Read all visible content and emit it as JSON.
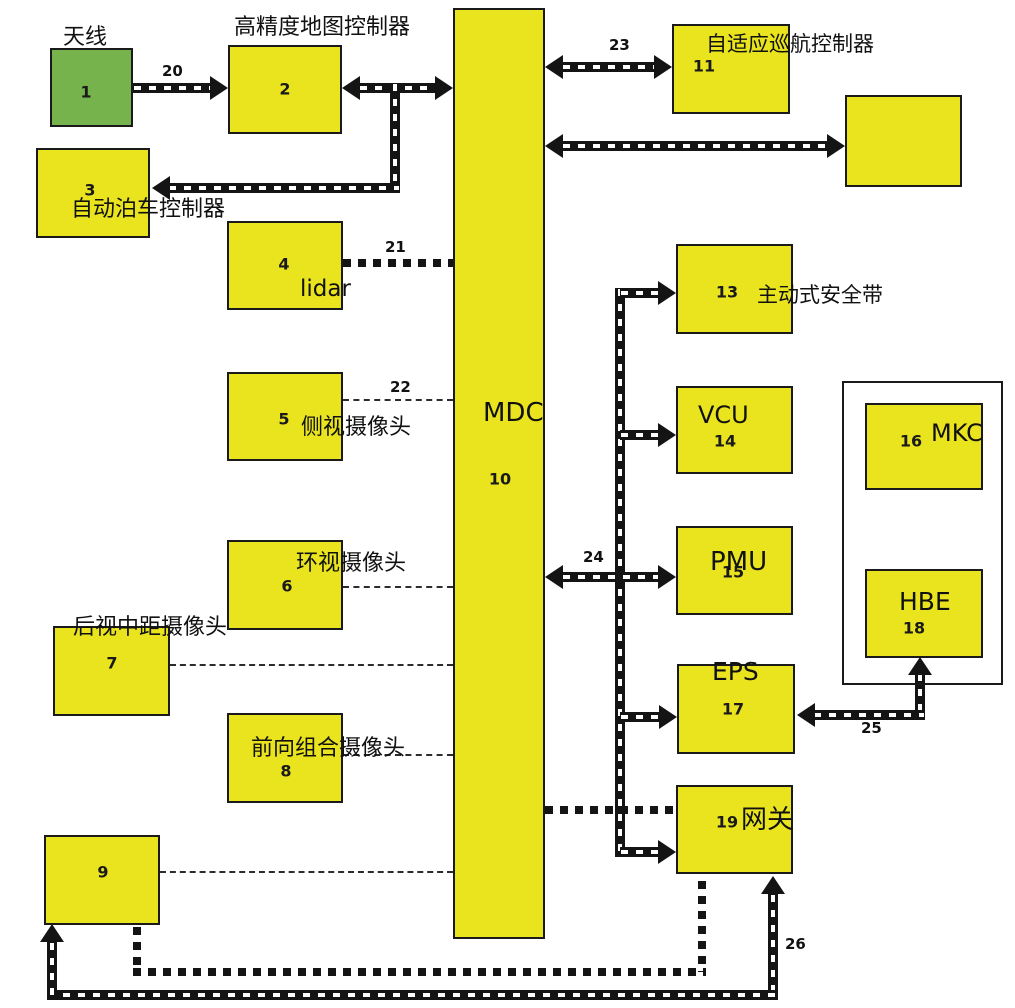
{
  "diagram": {
    "colors": {
      "box_fill": "#e9e41e",
      "antenna_fill": "#77b34d",
      "line": "#141414"
    },
    "nodes": [
      {
        "name": "node-antenna",
        "fill": "green",
        "num": "1",
        "x": 50,
        "y": 48,
        "w": 83,
        "h": 79,
        "numx": 86,
        "numy": 92
      },
      {
        "name": "node-hd-map-controller",
        "fill": "yellow",
        "num": "2",
        "x": 228,
        "y": 45,
        "w": 114,
        "h": 89,
        "numx": 285,
        "numy": 89
      },
      {
        "name": "node-auto-parking-controller",
        "fill": "yellow",
        "num": "3",
        "x": 36,
        "y": 148,
        "w": 114,
        "h": 90,
        "numx": 90,
        "numy": 190
      },
      {
        "name": "node-lidar",
        "fill": "yellow",
        "num": "4",
        "x": 227,
        "y": 221,
        "w": 116,
        "h": 89,
        "numx": 284,
        "numy": 264
      },
      {
        "name": "node-side-camera",
        "fill": "yellow",
        "num": "5",
        "x": 227,
        "y": 372,
        "w": 116,
        "h": 89,
        "numx": 284,
        "numy": 419
      },
      {
        "name": "node-surround-camera",
        "fill": "yellow",
        "num": "6",
        "x": 227,
        "y": 540,
        "w": 116,
        "h": 90,
        "numx": 287,
        "numy": 586
      },
      {
        "name": "node-rear-mid-camera",
        "fill": "yellow",
        "num": "7",
        "x": 53,
        "y": 626,
        "w": 117,
        "h": 90,
        "numx": 112,
        "numy": 663
      },
      {
        "name": "node-front-combo-camera",
        "fill": "yellow",
        "num": "8",
        "x": 227,
        "y": 713,
        "w": 116,
        "h": 90,
        "numx": 286,
        "numy": 771
      },
      {
        "name": "node-box-9",
        "fill": "yellow",
        "num": "9",
        "x": 44,
        "y": 835,
        "w": 116,
        "h": 90,
        "numx": 103,
        "numy": 872
      },
      {
        "name": "node-mdc",
        "fill": "yellow",
        "num": "10",
        "x": 453,
        "y": 8,
        "w": 92,
        "h": 931,
        "numx": 500,
        "numy": 479
      },
      {
        "name": "node-acc-controller",
        "fill": "yellow",
        "num": "11",
        "x": 672,
        "y": 24,
        "w": 118,
        "h": 90,
        "numx": 704,
        "numy": 66
      },
      {
        "name": "node-box-12",
        "fill": "yellow",
        "num": "",
        "x": 845,
        "y": 95,
        "w": 117,
        "h": 92,
        "numx": 0,
        "numy": 0
      },
      {
        "name": "node-active-seatbelt",
        "fill": "yellow",
        "num": "13",
        "x": 676,
        "y": 244,
        "w": 117,
        "h": 90,
        "numx": 727,
        "numy": 292
      },
      {
        "name": "node-vcu",
        "fill": "yellow",
        "num": "14",
        "x": 676,
        "y": 386,
        "w": 117,
        "h": 88,
        "numx": 725,
        "numy": 441
      },
      {
        "name": "node-pmu",
        "fill": "yellow",
        "num": "15",
        "x": 676,
        "y": 526,
        "w": 117,
        "h": 89,
        "numx": 733,
        "numy": 572
      },
      {
        "name": "node-mkc",
        "fill": "yellow",
        "num": "16",
        "x": 865,
        "y": 403,
        "w": 118,
        "h": 87,
        "numx": 911,
        "numy": 441
      },
      {
        "name": "node-eps",
        "fill": "yellow",
        "num": "17",
        "x": 677,
        "y": 664,
        "w": 118,
        "h": 90,
        "numx": 733,
        "numy": 709
      },
      {
        "name": "node-hbe",
        "fill": "yellow",
        "num": "18",
        "x": 865,
        "y": 569,
        "w": 118,
        "h": 89,
        "numx": 914,
        "numy": 628
      },
      {
        "name": "node-gateway",
        "fill": "yellow",
        "num": "19",
        "x": 676,
        "y": 785,
        "w": 117,
        "h": 89,
        "numx": 727,
        "numy": 822
      },
      {
        "name": "group-frame",
        "fill": "frame",
        "num": "",
        "x": 842,
        "y": 381,
        "w": 161,
        "h": 304,
        "numx": 0,
        "numy": 0
      }
    ],
    "labels": [
      {
        "name": "label-antenna",
        "text": "天线",
        "x": 63,
        "y": 26,
        "s": 22
      },
      {
        "name": "label-hd-map-controller",
        "text": "高精度地图控制器",
        "x": 234,
        "y": 16,
        "s": 22
      },
      {
        "name": "label-auto-parking-controller",
        "text": "自动泊车控制器",
        "x": 71,
        "y": 198,
        "s": 22
      },
      {
        "name": "label-lidar",
        "text": "lidar",
        "x": 300,
        "y": 277,
        "s": 23
      },
      {
        "name": "label-side-camera",
        "text": "侧视摄像头",
        "x": 301,
        "y": 416,
        "s": 22
      },
      {
        "name": "label-surround-camera",
        "text": "环视摄像头",
        "x": 296,
        "y": 552,
        "s": 22
      },
      {
        "name": "label-rear-mid-camera",
        "text": "后视中距摄像头",
        "x": 73,
        "y": 616,
        "s": 22
      },
      {
        "name": "label-front-combo-camera",
        "text": "前向组合摄像头",
        "x": 251,
        "y": 737,
        "s": 22
      },
      {
        "name": "label-mdc",
        "text": "MDC",
        "x": 483,
        "y": 400,
        "s": 26
      },
      {
        "name": "label-acc-controller",
        "text": "自适应巡航控制器",
        "x": 706,
        "y": 33,
        "s": 21
      },
      {
        "name": "label-active-seatbelt",
        "text": "主动式安全带",
        "x": 757,
        "y": 284,
        "s": 21
      },
      {
        "name": "label-vcu",
        "text": "VCU",
        "x": 698,
        "y": 403,
        "s": 24
      },
      {
        "name": "label-pmu",
        "text": "PMU",
        "x": 710,
        "y": 549,
        "s": 26
      },
      {
        "name": "label-eps",
        "text": "EPS",
        "x": 712,
        "y": 659,
        "s": 25
      },
      {
        "name": "label-mkc",
        "text": "MKC",
        "x": 931,
        "y": 421,
        "s": 24
      },
      {
        "name": "label-hbe",
        "text": "HBE",
        "x": 899,
        "y": 589,
        "s": 25
      },
      {
        "name": "label-gateway",
        "text": "网关",
        "x": 741,
        "y": 807,
        "s": 26
      },
      {
        "name": "edge-label-20",
        "text": "20",
        "x": 162,
        "y": 64,
        "s": 15,
        "bold": true
      },
      {
        "name": "edge-label-21",
        "text": "21",
        "x": 385,
        "y": 240,
        "s": 15,
        "bold": true
      },
      {
        "name": "edge-label-22",
        "text": "22",
        "x": 390,
        "y": 380,
        "s": 15,
        "bold": true
      },
      {
        "name": "edge-label-23",
        "text": "23",
        "x": 609,
        "y": 38,
        "s": 15,
        "bold": true
      },
      {
        "name": "edge-label-24",
        "text": "24",
        "x": 583,
        "y": 550,
        "s": 15,
        "bold": true
      },
      {
        "name": "edge-label-25",
        "text": "25",
        "x": 861,
        "y": 721,
        "s": 15,
        "bold": true
      },
      {
        "name": "edge-label-26",
        "text": "26",
        "x": 785,
        "y": 937,
        "s": 15,
        "bold": true
      }
    ],
    "lines": [
      {
        "name": "edge-20",
        "t": "rail-h",
        "x": 133,
        "y": 83,
        "len": 78
      },
      {
        "name": "edge-2-mdc",
        "t": "rail-h",
        "x": 359,
        "y": 83,
        "len": 78
      },
      {
        "name": "edge-branch-3-v",
        "t": "rail-v",
        "x": 390,
        "y": 83,
        "len": 110
      },
      {
        "name": "edge-branch-3-h",
        "t": "rail-h",
        "x": 168,
        "y": 183,
        "len": 232
      },
      {
        "name": "edge-23",
        "t": "rail-h",
        "x": 562,
        "y": 62,
        "len": 94
      },
      {
        "name": "edge-mdc-12",
        "t": "rail-h",
        "x": 562,
        "y": 141,
        "len": 267
      },
      {
        "name": "trunk-line",
        "t": "rail-v",
        "x": 615,
        "y": 288,
        "len": 569
      },
      {
        "name": "branch-13",
        "t": "rail-h",
        "x": 620,
        "y": 288,
        "len": 40
      },
      {
        "name": "branch-14",
        "t": "rail-h",
        "x": 620,
        "y": 430,
        "len": 40
      },
      {
        "name": "edge-24",
        "t": "rail-h",
        "x": 562,
        "y": 572,
        "len": 98
      },
      {
        "name": "branch-17",
        "t": "rail-h",
        "x": 620,
        "y": 712,
        "len": 41
      },
      {
        "name": "branch-19",
        "t": "rail-h",
        "x": 620,
        "y": 847,
        "len": 40
      },
      {
        "name": "edge-25-v",
        "t": "rail-v",
        "x": 915,
        "y": 673,
        "len": 47
      },
      {
        "name": "edge-25-h",
        "t": "rail-h",
        "x": 813,
        "y": 710,
        "len": 112
      },
      {
        "name": "edge-26",
        "t": "rail-v",
        "x": 768,
        "y": 894,
        "len": 106
      },
      {
        "name": "bottom-bus",
        "t": "rail-h",
        "x": 47,
        "y": 990,
        "len": 731
      },
      {
        "name": "edge-9-up",
        "t": "rail-v",
        "x": 47,
        "y": 942,
        "len": 58
      },
      {
        "name": "edge-21",
        "t": "dot-h",
        "x": 343,
        "y": 259,
        "len": 110
      },
      {
        "name": "edge-mdc-19-dot",
        "t": "dot-h",
        "x": 545,
        "y": 806,
        "len": 131
      },
      {
        "name": "edge-9-19-v1",
        "t": "dot-v",
        "x": 133,
        "y": 927,
        "len": 45
      },
      {
        "name": "edge-9-19-h",
        "t": "dot-h",
        "x": 133,
        "y": 968,
        "len": 573
      },
      {
        "name": "edge-9-19-v2",
        "t": "dot-v",
        "x": 698,
        "y": 881,
        "len": 91
      },
      {
        "name": "edge-22",
        "t": "dash-h",
        "x": 343,
        "y": 399,
        "len": 110
      },
      {
        "name": "edge-6-dash",
        "t": "dash-h",
        "x": 343,
        "y": 586,
        "len": 110
      },
      {
        "name": "edge-7-dash",
        "t": "dash-h",
        "x": 170,
        "y": 664,
        "len": 283
      },
      {
        "name": "edge-8-dash",
        "t": "dash-h",
        "x": 343,
        "y": 754,
        "len": 110
      },
      {
        "name": "edge-9-dash",
        "t": "dash-h",
        "x": 160,
        "y": 871,
        "len": 293
      }
    ],
    "arrowheads": [
      {
        "name": "arrowhead-20-right",
        "dir": "right",
        "x": 228,
        "y": 88
      },
      {
        "name": "arrowhead-2-left",
        "dir": "left",
        "x": 342,
        "y": 88
      },
      {
        "name": "arrowhead-mdc-right",
        "dir": "right",
        "x": 453,
        "y": 88
      },
      {
        "name": "arrowhead-3-left",
        "dir": "left",
        "x": 152,
        "y": 188
      },
      {
        "name": "arrowhead-23-left",
        "dir": "left",
        "x": 545,
        "y": 67
      },
      {
        "name": "arrowhead-23-right",
        "dir": "right",
        "x": 672,
        "y": 67
      },
      {
        "name": "arrowhead-12-left",
        "dir": "left",
        "x": 545,
        "y": 146
      },
      {
        "name": "arrowhead-12-right",
        "dir": "right",
        "x": 845,
        "y": 146
      },
      {
        "name": "arrowhead-13-right",
        "dir": "right",
        "x": 676,
        "y": 293
      },
      {
        "name": "arrowhead-14-right",
        "dir": "right",
        "x": 676,
        "y": 435
      },
      {
        "name": "arrowhead-24-left",
        "dir": "left",
        "x": 545,
        "y": 577
      },
      {
        "name": "arrowhead-24-right",
        "dir": "right",
        "x": 676,
        "y": 577
      },
      {
        "name": "arrowhead-17-right",
        "dir": "right",
        "x": 677,
        "y": 717
      },
      {
        "name": "arrowhead-19-right",
        "dir": "right",
        "x": 676,
        "y": 852
      },
      {
        "name": "arrowhead-25-left",
        "dir": "left",
        "x": 797,
        "y": 715
      },
      {
        "name": "arrowhead-25-up",
        "dir": "up",
        "x": 920,
        "y": 657
      },
      {
        "name": "arrowhead-26-up",
        "dir": "up",
        "x": 773,
        "y": 876
      },
      {
        "name": "arrowhead-9-up",
        "dir": "up",
        "x": 52,
        "y": 924
      }
    ]
  }
}
